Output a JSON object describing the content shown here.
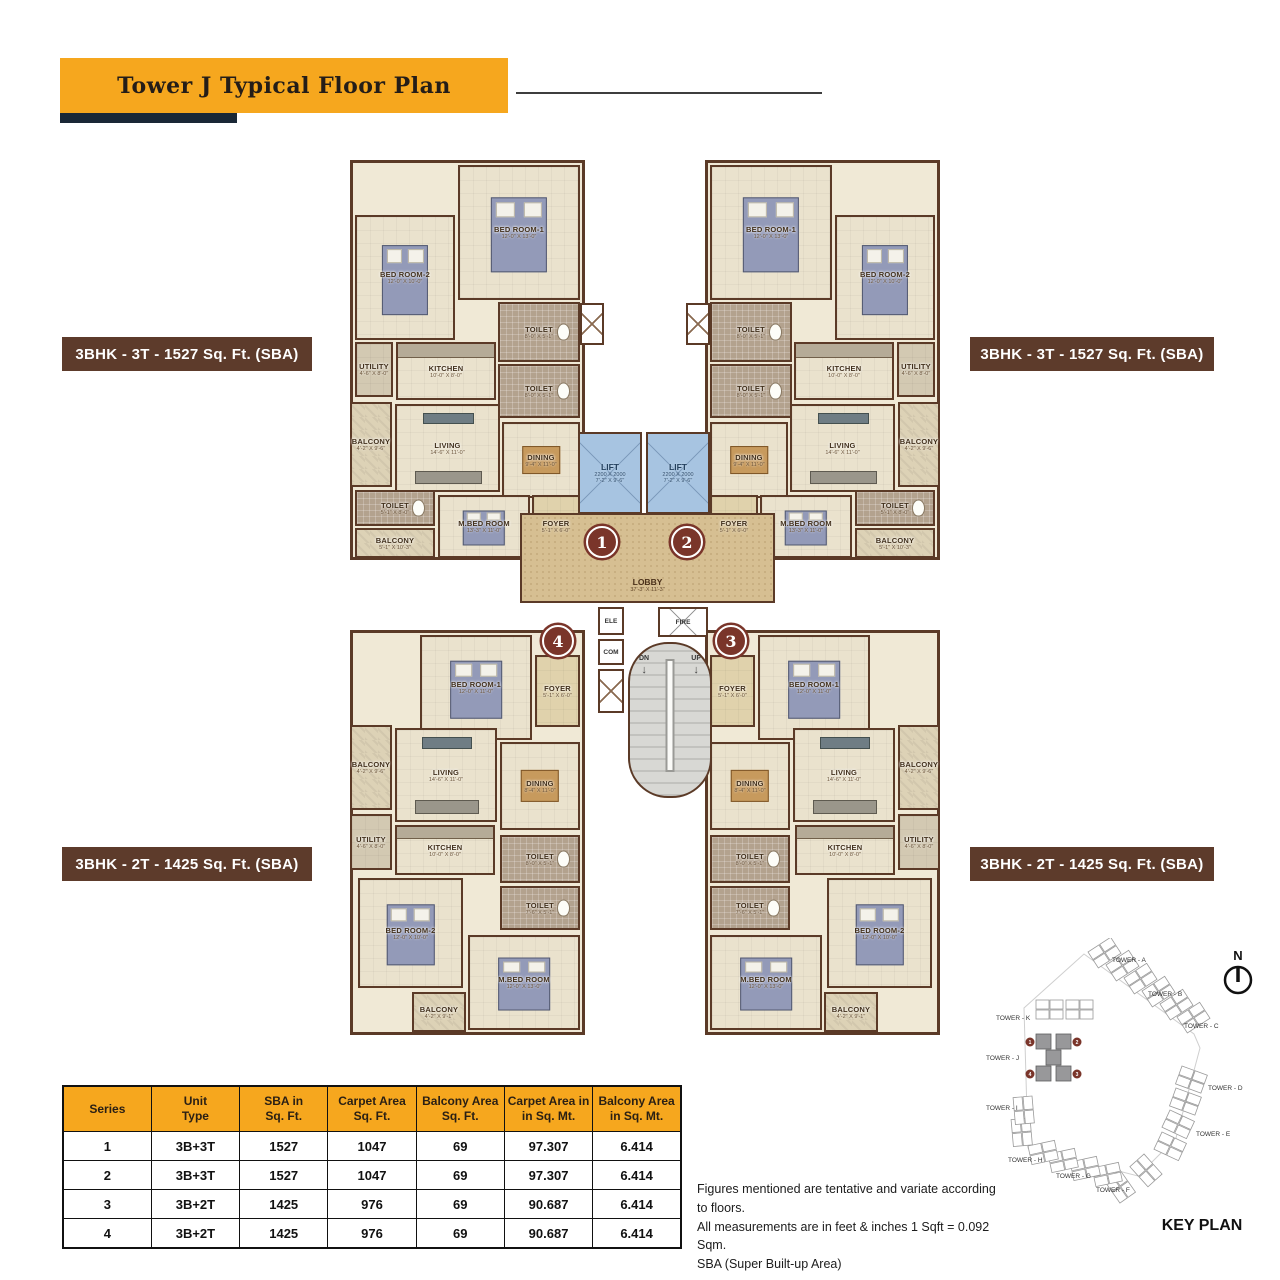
{
  "header": {
    "title": "Tower J Typical Floor Plan"
  },
  "unit_labels": {
    "top_left": "3BHK - 3T - 1527 Sq. Ft. (SBA)",
    "top_right": "3BHK - 3T - 1527 Sq. Ft. (SBA)",
    "bottom_left": "3BHK - 2T - 1425 Sq. Ft. (SBA)",
    "bottom_right": "3BHK - 2T - 1425 Sq. Ft. (SBA)"
  },
  "floor_plan": {
    "markers": {
      "m1": "1",
      "m2": "2",
      "m3": "3",
      "m4": "4"
    },
    "core": {
      "lift": {
        "name": "LIFT",
        "dim_mm": "2200 X 2000",
        "dim_ft": "7'-2\" X 9'-6\""
      },
      "lobby": {
        "name": "LOBBY",
        "dim": "37'-3\" X 11'-3\""
      },
      "stair": {
        "dn": "DN",
        "up": "UP"
      },
      "ele": "ELE",
      "com": "COM",
      "fire": "FIRE"
    },
    "unit_3t": {
      "bed1": {
        "name": "BED ROOM-1",
        "dim": "12'-0\" X 13'-0\""
      },
      "bed2": {
        "name": "BED ROOM-2",
        "dim": "12'-0\" X 10'-0\""
      },
      "toilet1": {
        "name": "TOILET",
        "dim": "8'-0\" X 5'-1\""
      },
      "toilet2": {
        "name": "TOILET",
        "dim": "8'-0\" X 5'-1\""
      },
      "toilet3": {
        "name": "TOILET",
        "dim": "5'-1\" X 8'-0\""
      },
      "utility": {
        "name": "UTILITY",
        "dim": "4'-6\" X 8'-0\""
      },
      "kitchen": {
        "name": "KITCHEN",
        "dim": "10'-0\" X 8'-0\""
      },
      "balcony1": {
        "name": "BALCONY",
        "dim": "4'-2\" X 9'-6\""
      },
      "balcony2": {
        "name": "BALCONY",
        "dim": "5'-1\" X 10'-3\""
      },
      "living": {
        "name": "LIVING",
        "dim": "14'-6\" X 11'-0\""
      },
      "dining": {
        "name": "DINING",
        "dim": "9'-4\" X 11'-0\""
      },
      "mbed": {
        "name": "M.BED ROOM",
        "dim": "13'-3\" X 11'-0\""
      },
      "foyer": {
        "name": "FOYER",
        "dim": "5'-1\" X 6'-0\""
      }
    },
    "unit_2t": {
      "bed1": {
        "name": "BED ROOM-1",
        "dim": "12'-0\" X 11'-0\""
      },
      "foyer": {
        "name": "FOYER",
        "dim": "5'-1\" X 6'-0\""
      },
      "balcony1": {
        "name": "BALCONY",
        "dim": "4'-2\" X 9'-6\""
      },
      "living": {
        "name": "LIVING",
        "dim": "14'-6\" X 11'-0\""
      },
      "dining": {
        "name": "DINING",
        "dim": "8'-4\" X 11'-0\""
      },
      "utility": {
        "name": "UTILITY",
        "dim": "4'-6\" X 8'-0\""
      },
      "kitchen": {
        "name": "KITCHEN",
        "dim": "10'-0\" X 8'-0\""
      },
      "toilet1": {
        "name": "TOILET",
        "dim": "8'-0\" X 5'-1\""
      },
      "toilet2": {
        "name": "TOILET",
        "dim": "7'-6\" X 5'-1\""
      },
      "bed2": {
        "name": "BED ROOM-2",
        "dim": "12'-0\" X 10'-0\""
      },
      "mbed": {
        "name": "M.BED ROOM",
        "dim": "12'-0\" X 13'-0\""
      },
      "balcony2": {
        "name": "BALCONY",
        "dim": "4'-2\" X 9'-1\""
      }
    }
  },
  "table": {
    "headers": [
      "Series",
      "Unit\nType",
      "SBA in\nSq. Ft.",
      "Carpet Area\nSq. Ft.",
      "Balcony Area\nSq. Ft.",
      "Carpet Area in\nin Sq. Mt.",
      "Balcony Area\nin Sq. Mt."
    ],
    "rows": [
      [
        "1",
        "3B+3T",
        "1527",
        "1047",
        "69",
        "97.307",
        "6.414"
      ],
      [
        "2",
        "3B+3T",
        "1527",
        "1047",
        "69",
        "97.307",
        "6.414"
      ],
      [
        "3",
        "3B+2T",
        "1425",
        "976",
        "69",
        "90.687",
        "6.414"
      ],
      [
        "4",
        "3B+2T",
        "1425",
        "976",
        "69",
        "90.687",
        "6.414"
      ]
    ]
  },
  "notes": [
    "Figures mentioned are tentative and variate according to floors.",
    "All measurements are in feet & inches 1 Sqft = 0.092 Sqm.",
    "SBA (Super Built-up Area)"
  ],
  "key_plan": {
    "title": "KEY PLAN",
    "north": "N",
    "towers": [
      "TOWER - A",
      "TOWER - B",
      "TOWER - C",
      "TOWER - D",
      "TOWER - E",
      "TOWER - F",
      "TOWER - G",
      "TOWER - H",
      "TOWER - I",
      "TOWER - J",
      "TOWER - K"
    ]
  }
}
